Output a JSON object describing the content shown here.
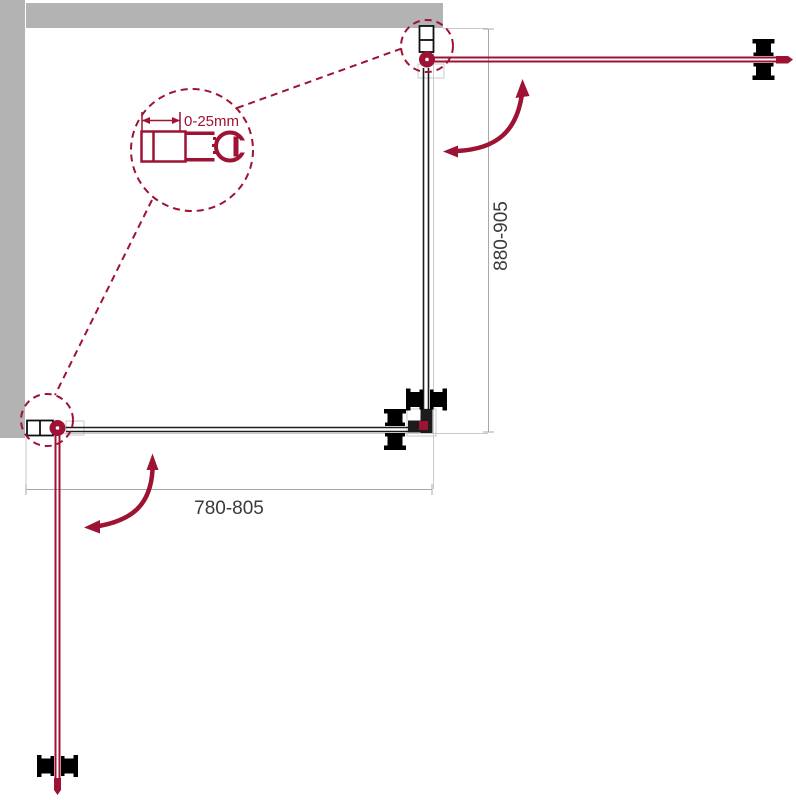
{
  "page": {
    "title": "Shower enclosure dimension diagram (top view)"
  },
  "labels": {
    "width_range": "780-805",
    "height_range": "880-905",
    "adjustment_range": "0-25mm"
  },
  "colors": {
    "accent_red": "#9E1233",
    "wall_gray": "#B3B3B3",
    "ghost_gray": "#C9C9C9",
    "dim_gray": "#A8A8A8",
    "panel_dark": "#1C1C1C",
    "text_dark": "#3A3A3A",
    "background": "#FFFFFF"
  }
}
